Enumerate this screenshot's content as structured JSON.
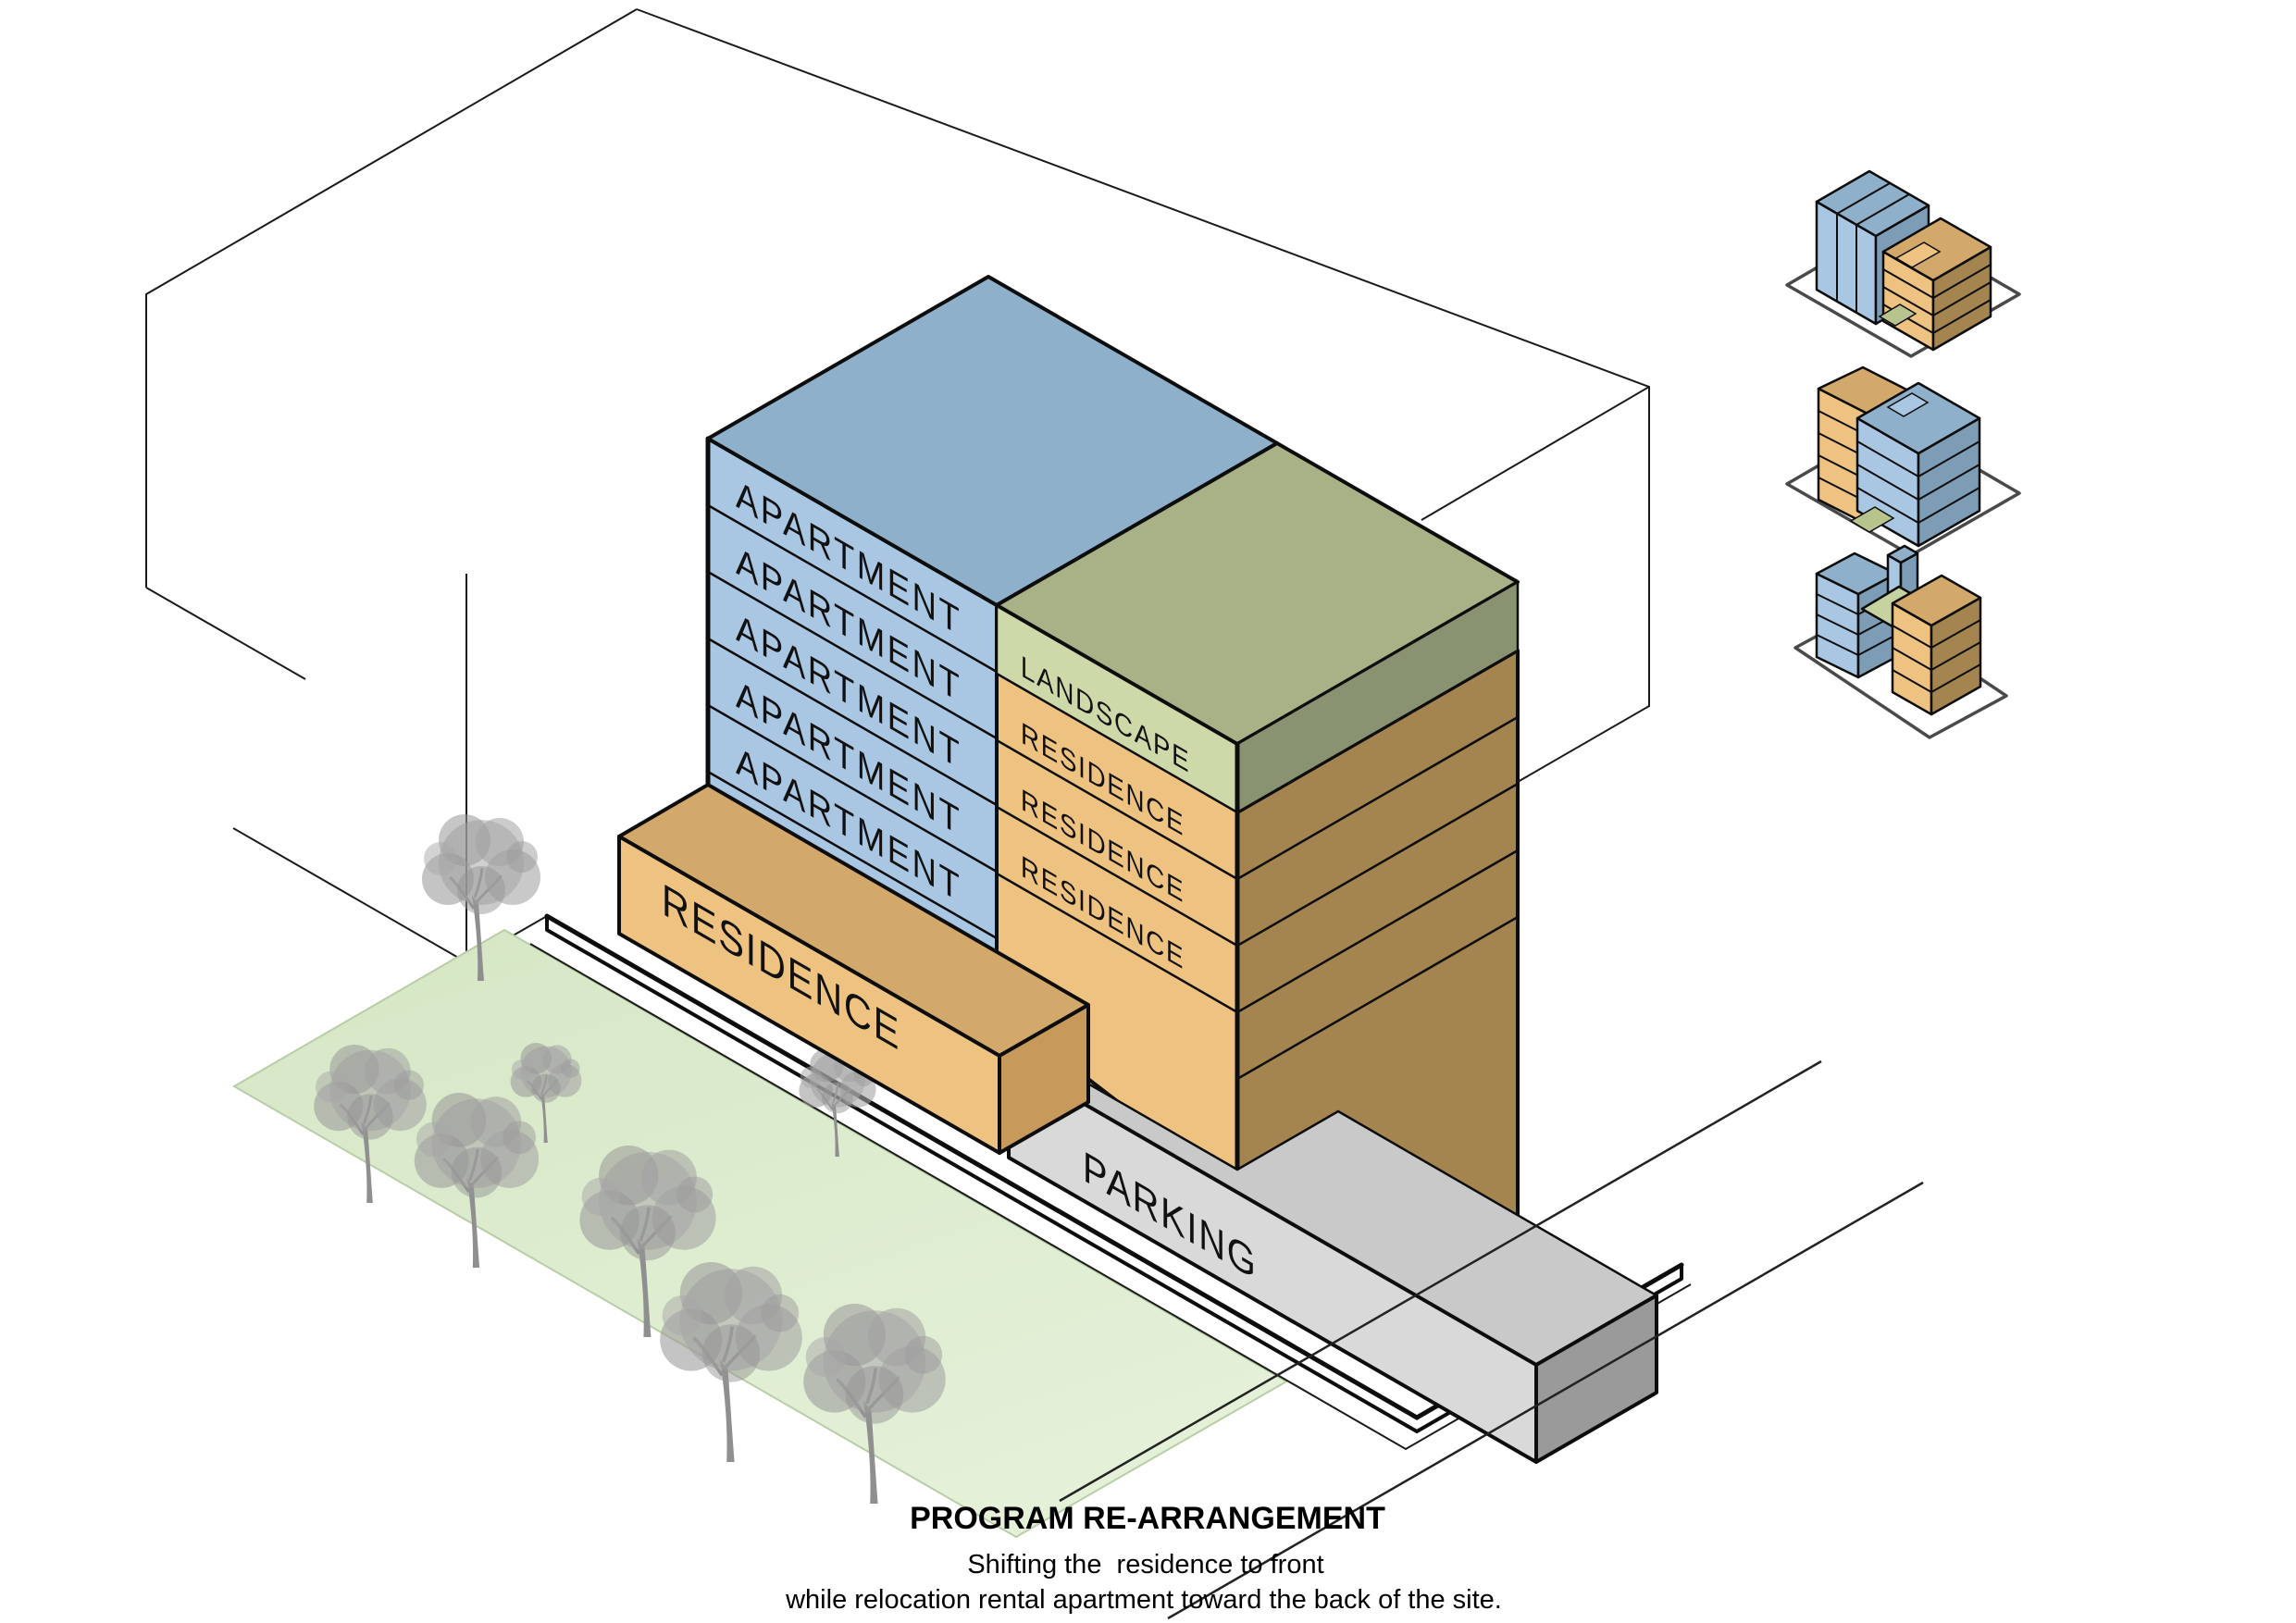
{
  "diagram": {
    "building": {
      "apartment_labels": [
        "APARTMENT",
        "APARTMENT",
        "APARTMENT",
        "APARTMENT",
        "APARTMENT"
      ],
      "landscape_label": "LANDSCAPE",
      "residence_labels": [
        "RESIDENCE",
        "RESIDENCE",
        "RESIDENCE"
      ],
      "podium_label": "RESIDENCE",
      "parking_label": "PARKING"
    },
    "caption": {
      "title": "PROGRAM RE-ARRANGEMENT",
      "line1": "Shifting the  residence to front",
      "line2": "while relocation rental apartment toward the back of the site."
    },
    "colors": {
      "apartment_side": "#a9c7e3",
      "apartment_top": "#8fb0ca",
      "apartment_dark": "#7d9cb6",
      "landscape_top": "#a9b287",
      "landscape_band": "#cdd9a8",
      "landscape_dark": "#8a9371",
      "residence_side": "#eec381",
      "residence_top": "#d2a96a",
      "residence_dark": "#a5854f",
      "parking_side": "#d9d9d9",
      "parking_top": "#c9c9c9",
      "parking_dark": "#9a9a9a",
      "lawn": "#dcebce",
      "tree": "#9d9d9d"
    }
  }
}
